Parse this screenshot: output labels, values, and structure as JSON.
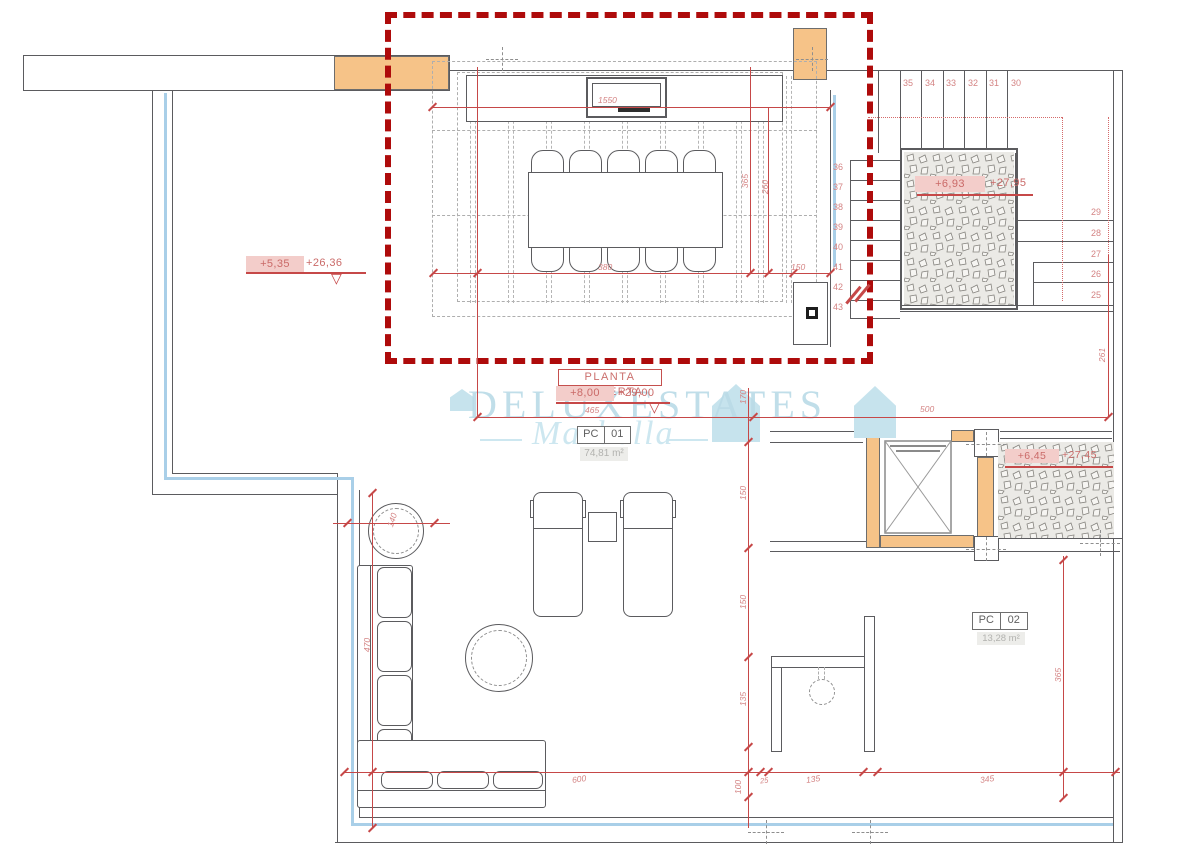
{
  "plan": {
    "title": "PLANTA CUBIERTA"
  },
  "levels": {
    "title": {
      "a": "+8,00",
      "b": "+29,00"
    },
    "terrace": {
      "a": "+5,35",
      "b": "+26,36"
    },
    "stair": {
      "a": "+6,93",
      "b": "+27,95"
    },
    "landing": {
      "a": "+6,45",
      "b": "+27,45"
    }
  },
  "rooms": [
    {
      "code": "PC",
      "num": "01",
      "area": "74,81 m²"
    },
    {
      "code": "PC",
      "num": "02",
      "area": "13,28 m²"
    }
  ],
  "stairs": {
    "top_run": [
      "35",
      "34",
      "33",
      "32",
      "31",
      "30"
    ],
    "side_run": [
      "36",
      "37",
      "38",
      "39",
      "40",
      "41",
      "42",
      "43"
    ],
    "lower_run": [
      "29",
      "28",
      "27",
      "26",
      "25"
    ]
  },
  "dims": {
    "pergola_w": "1550",
    "table_w": "380",
    "gap": "150",
    "col_a": "365",
    "col_b": "260",
    "terrace_w": "465",
    "upper_w": "500",
    "sofa_h": "470",
    "round_d": "140",
    "bottom_a": "600",
    "bottom_b": "25",
    "bottom_c": "135",
    "bottom_d": "345",
    "right_a": "261",
    "right_b": "365",
    "chain_a": "170",
    "chain_b": "150",
    "chain_c": "150",
    "chain_d": "135",
    "chain_e": "100"
  },
  "watermark": {
    "name": "DELUXESTATES",
    "city": "Marbella"
  }
}
